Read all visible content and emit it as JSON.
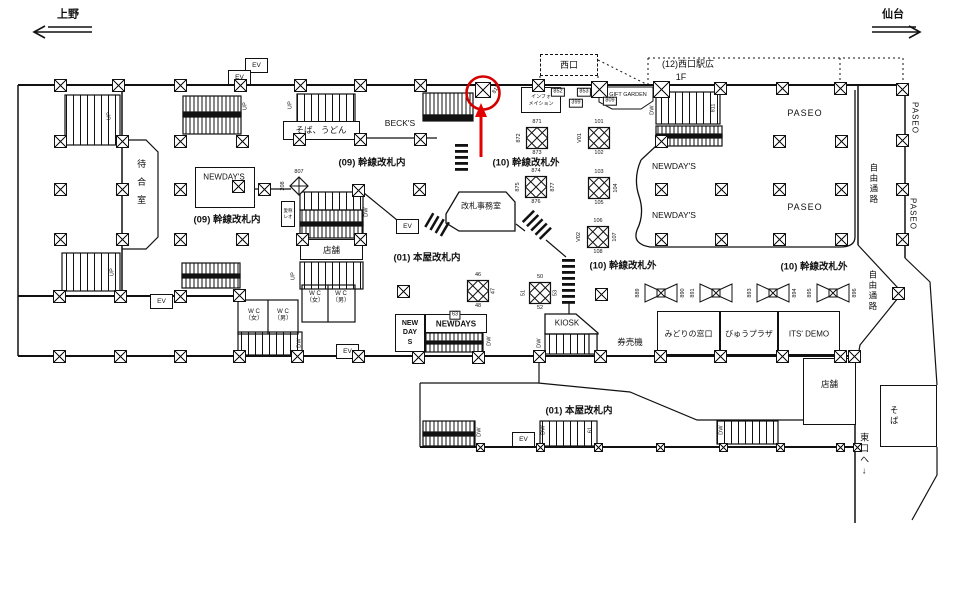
{
  "nav": {
    "left_station": "上野",
    "right_station": "仙台"
  },
  "labels": {
    "west_gate": "西口",
    "info_1": "インフォ",
    "info_2": "メイション",
    "gift_garden": "GIFT GARDEN",
    "west_plaza": "(12)西口駅広",
    "west_plaza_floor": "1F",
    "soba_udon": "そば、うどん",
    "becks": "BECK'S",
    "waiting_room": "待合室",
    "newdays": "NEWDAY'S",
    "kansen_in": "(09) 幹線改札内",
    "kansen_out": "(10) 幹線改札外",
    "honya_in": "(01) 本屋改札内",
    "office": "改札事務室",
    "reo_1": "愛称",
    "reo_2": "レオ",
    "tempo": "店舗",
    "wc": "W C",
    "wc_female": "（女）",
    "wc_male": "（男）",
    "new_day_s_1": "NEW",
    "new_day_s_2": "DAY",
    "new_day_s_3": "S",
    "newdays_caps": "NEWDAYS",
    "kiosk": "KIOSK",
    "ticket_machines": "券売機",
    "midori_madoguchi": "みどりの窓口",
    "view_plaza": "びゅうプラザ",
    "its_demo": "ITS' DEMO",
    "paseo": "PASEO",
    "jiyu_tsuro": "自由通路",
    "soba": "そば",
    "east_exit": "東口へ↓",
    "ev": "EV"
  },
  "highlight": {
    "color": "#d40000",
    "circled_number": "818"
  },
  "ad_markers": [
    {
      "type": "cluster",
      "x": 537,
      "y": 138,
      "top": "871",
      "left": "872",
      "bottom": "873"
    },
    {
      "type": "cluster",
      "x": 599,
      "y": 138,
      "top": "101",
      "left": "V01",
      "bottom": "102"
    },
    {
      "type": "cluster",
      "x": 536,
      "y": 187,
      "top": "874",
      "left": "875",
      "right": "877",
      "bottom": "876"
    },
    {
      "type": "cluster",
      "x": 599,
      "y": 188,
      "top": "103",
      "right": "104",
      "bottom": "105"
    },
    {
      "type": "cluster",
      "x": 598,
      "y": 237,
      "top": "106",
      "left": "V02",
      "right": "107",
      "bottom": "108"
    },
    {
      "type": "cluster",
      "x": 478,
      "y": 291,
      "top": "46",
      "right": "47",
      "bottom": "48"
    },
    {
      "type": "cluster",
      "x": 540,
      "y": 293,
      "top": "50",
      "left": "51",
      "right": "53",
      "bottom": "52"
    },
    {
      "type": "bowtie",
      "x": 661,
      "y": 293,
      "left": "889",
      "right": "890"
    },
    {
      "type": "bowtie",
      "x": 716,
      "y": 293,
      "left": "891"
    },
    {
      "type": "bowtie",
      "x": 773,
      "y": 293,
      "left": "893",
      "right": "894"
    },
    {
      "type": "bowtie",
      "x": 833,
      "y": 293,
      "left": "895",
      "right": "896"
    },
    {
      "type": "diamond",
      "x": 299,
      "y": 186,
      "top": "807",
      "left": "208"
    }
  ],
  "number_tags": [
    {
      "x": 558,
      "y": 92,
      "label": "852"
    },
    {
      "x": 584,
      "y": 92,
      "label": "853"
    },
    {
      "x": 576,
      "y": 103,
      "label": "399"
    },
    {
      "x": 610,
      "y": 101,
      "label": "809"
    },
    {
      "x": 455,
      "y": 315,
      "label": "63"
    }
  ],
  "rotated_numbers": [
    {
      "x": 714,
      "y": 108,
      "label": "811",
      "rot": -90
    },
    {
      "x": 497,
      "y": 90,
      "label": "818",
      "rot": -55
    },
    {
      "x": 591,
      "y": 430,
      "label": "61",
      "rot": -90
    }
  ],
  "stair_labels": [
    {
      "x": 110,
      "y": 116,
      "label": "UP"
    },
    {
      "x": 246,
      "y": 106,
      "label": "UP"
    },
    {
      "x": 291,
      "y": 105,
      "label": "UP"
    },
    {
      "x": 113,
      "y": 272,
      "label": "UP"
    },
    {
      "x": 294,
      "y": 276,
      "label": "UP"
    },
    {
      "x": 653,
      "y": 110,
      "label": "DW"
    },
    {
      "x": 367,
      "y": 212,
      "label": "DW"
    },
    {
      "x": 490,
      "y": 341,
      "label": "DW"
    },
    {
      "x": 540,
      "y": 343,
      "label": "DW"
    },
    {
      "x": 300,
      "y": 343,
      "label": "DW"
    },
    {
      "x": 480,
      "y": 432,
      "label": "DW"
    },
    {
      "x": 544,
      "y": 430,
      "label": "DW"
    },
    {
      "x": 722,
      "y": 430,
      "label": "DW"
    }
  ],
  "pillars": {
    "large": [
      [
        60,
        85
      ],
      [
        118,
        85
      ],
      [
        180,
        85
      ],
      [
        240,
        85
      ],
      [
        300,
        85
      ],
      [
        360,
        85
      ],
      [
        420,
        85
      ],
      [
        538,
        85
      ],
      [
        720,
        88
      ],
      [
        782,
        88
      ],
      [
        840,
        88
      ],
      [
        902,
        89
      ],
      [
        60,
        141
      ],
      [
        122,
        141
      ],
      [
        180,
        141
      ],
      [
        242,
        141
      ],
      [
        299,
        139
      ],
      [
        360,
        139
      ],
      [
        420,
        139
      ],
      [
        661,
        141
      ],
      [
        779,
        141
      ],
      [
        841,
        141
      ],
      [
        60,
        189
      ],
      [
        122,
        189
      ],
      [
        180,
        189
      ],
      [
        238,
        186
      ],
      [
        264,
        189
      ],
      [
        358,
        190
      ],
      [
        419,
        189
      ],
      [
        661,
        189
      ],
      [
        721,
        189
      ],
      [
        779,
        189
      ],
      [
        841,
        189
      ],
      [
        60,
        239
      ],
      [
        122,
        239
      ],
      [
        180,
        239
      ],
      [
        242,
        239
      ],
      [
        302,
        239
      ],
      [
        360,
        239
      ],
      [
        661,
        239
      ],
      [
        721,
        239
      ],
      [
        779,
        239
      ],
      [
        841,
        239
      ],
      [
        59,
        296
      ],
      [
        120,
        296
      ],
      [
        180,
        296
      ],
      [
        239,
        295
      ],
      [
        403,
        291
      ],
      [
        601,
        294
      ],
      [
        898,
        293
      ],
      [
        59,
        356
      ],
      [
        120,
        356
      ],
      [
        180,
        356
      ],
      [
        239,
        356
      ],
      [
        297,
        356
      ],
      [
        358,
        356
      ],
      [
        418,
        357
      ],
      [
        478,
        357
      ],
      [
        539,
        356
      ],
      [
        600,
        356
      ],
      [
        660,
        356
      ],
      [
        720,
        356
      ],
      [
        782,
        356
      ],
      [
        840,
        356
      ],
      [
        854,
        356
      ],
      [
        902,
        140
      ],
      [
        902,
        189
      ],
      [
        902,
        239
      ]
    ],
    "big": [
      [
        599,
        89
      ],
      [
        661,
        89
      ]
    ],
    "small": [
      [
        480,
        447
      ],
      [
        540,
        447
      ],
      [
        598,
        447
      ],
      [
        660,
        447
      ],
      [
        723,
        447
      ],
      [
        780,
        447
      ],
      [
        840,
        447
      ],
      [
        857,
        447
      ]
    ],
    "highlighted": [
      483,
      90
    ]
  }
}
